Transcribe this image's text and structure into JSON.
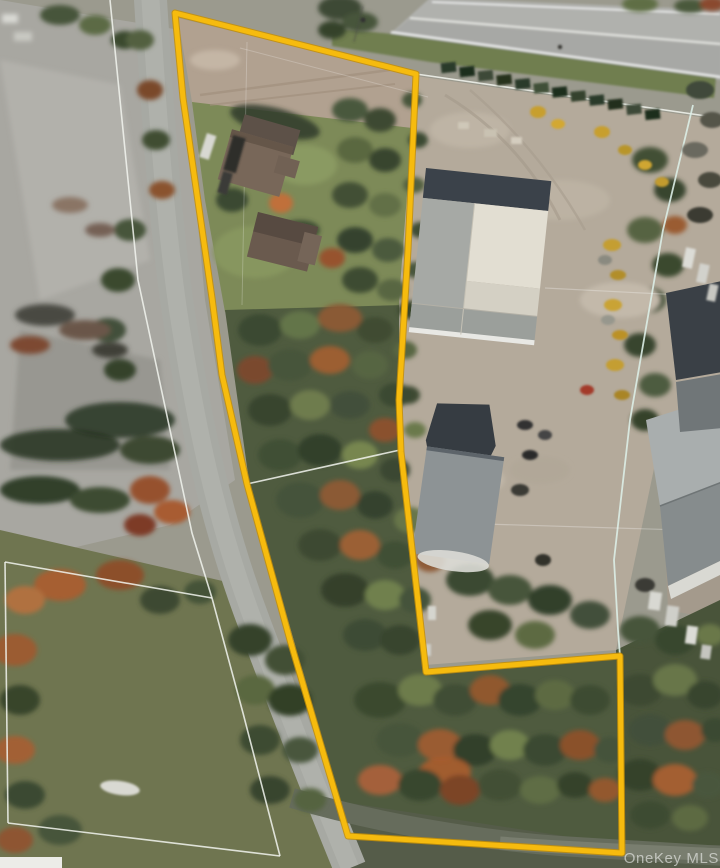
{
  "map": {
    "type": "satellite-aerial",
    "watermark_text": "OneKey MLS",
    "boundary_color": "#F6BB0E",
    "parcel_line_color": "#FFFFFF",
    "property_boundary_points": "175,13 416,74 408,250 399,400 401,452 426,672 620,656 622,853 348,836 320,742 290,640 247,484 222,375 212,298 183,98",
    "parcel_lines": [
      {
        "name": "west-road-parcel-line",
        "points": "110,0 138,280 192,533 212,598 243,713 280,856"
      },
      {
        "name": "house-lot-north-line",
        "points": "5,562 212,598"
      },
      {
        "name": "house-lot-south-line",
        "points": "8,823 123,837 280,856"
      },
      {
        "name": "house-lot-west-line",
        "points": "5,562 8,823"
      },
      {
        "name": "interior-cross-line",
        "points": "247,484 400,450"
      },
      {
        "name": "north-parcel-line",
        "points": "416,74 720,118"
      },
      {
        "name": "east-parcel-line",
        "points": "693,105 663,230 630,420 614,560 618,630 620,656"
      },
      {
        "name": "faint-survey-line-1",
        "points": "545,288 720,297"
      },
      {
        "name": "faint-survey-line-2",
        "points": "420,522 715,531"
      }
    ]
  }
}
